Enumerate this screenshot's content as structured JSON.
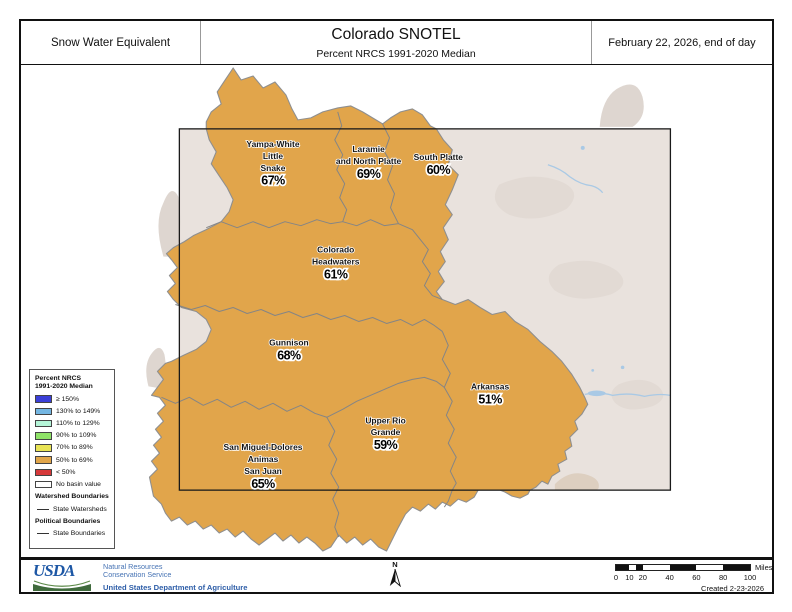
{
  "header": {
    "left_label": "Snow Water Equivalent",
    "title": "Colorado SNOTEL",
    "subtitle": "Percent NRCS 1991-2020 Median",
    "date_label": "February 22, 2026, end of day"
  },
  "map": {
    "basins": [
      {
        "name_lines": [
          "Yampa-White",
          "Little",
          "Snake"
        ],
        "value": "67%",
        "x": 253,
        "y": 82
      },
      {
        "name_lines": [
          "Laramie",
          "and North Platte"
        ],
        "value": "69%",
        "x": 349,
        "y": 87
      },
      {
        "name_lines": [
          "South Platte"
        ],
        "value": "60%",
        "x": 419,
        "y": 95
      },
      {
        "name_lines": [
          "Colorado",
          "Headwaters"
        ],
        "value": "61%",
        "x": 316,
        "y": 188
      },
      {
        "name_lines": [
          "Gunnison"
        ],
        "value": "68%",
        "x": 269,
        "y": 281
      },
      {
        "name_lines": [
          "Arkansas"
        ],
        "value": "51%",
        "x": 471,
        "y": 325
      },
      {
        "name_lines": [
          "Upper Rio",
          "Grande"
        ],
        "value": "59%",
        "x": 366,
        "y": 359
      },
      {
        "name_lines": [
          "San Miguel-Dolores",
          "Animas",
          "San Juan"
        ],
        "value": "65%",
        "x": 243,
        "y": 386
      }
    ],
    "colors": {
      "basin_fill": "#e1a54b",
      "basin_outline": "#8f8f8f",
      "hillshade": "#e9e2dd",
      "terrain_patch": "#ded6d0",
      "river": "#a9c9e5",
      "state_line": "#1a1a1a"
    }
  },
  "legend": {
    "title_lines": [
      "Percent NRCS",
      "1991-2020 Median"
    ],
    "items": [
      {
        "label": "≥ 150%",
        "color": "#3b3fd8"
      },
      {
        "label": "130% to 149%",
        "color": "#74b6e2"
      },
      {
        "label": "110% to 129%",
        "color": "#b5f5d8"
      },
      {
        "label": "90% to 109%",
        "color": "#8fe368"
      },
      {
        "label": "70% to 89%",
        "color": "#e9e455"
      },
      {
        "label": "50% to 69%",
        "color": "#e2a64a"
      },
      {
        "label": "< 50%",
        "color": "#d6393a"
      },
      {
        "label": "No basin value",
        "color": "#ffffff"
      }
    ],
    "sections": [
      {
        "heading": "Watershed Boundaries",
        "line_label": "State Watersheds"
      },
      {
        "heading": "Political Boundaries",
        "line_label": "State Boundaries"
      }
    ]
  },
  "footer": {
    "usda": "USDA",
    "agency_lines": [
      "Natural Resources",
      "Conservation Service"
    ],
    "dept": "United States Department of Agriculture",
    "north_label": "N",
    "scale": {
      "ticks": [
        0,
        10,
        20,
        40,
        60,
        80,
        100
      ],
      "unit": "Miles"
    },
    "created": "Created 2-23-2026"
  }
}
